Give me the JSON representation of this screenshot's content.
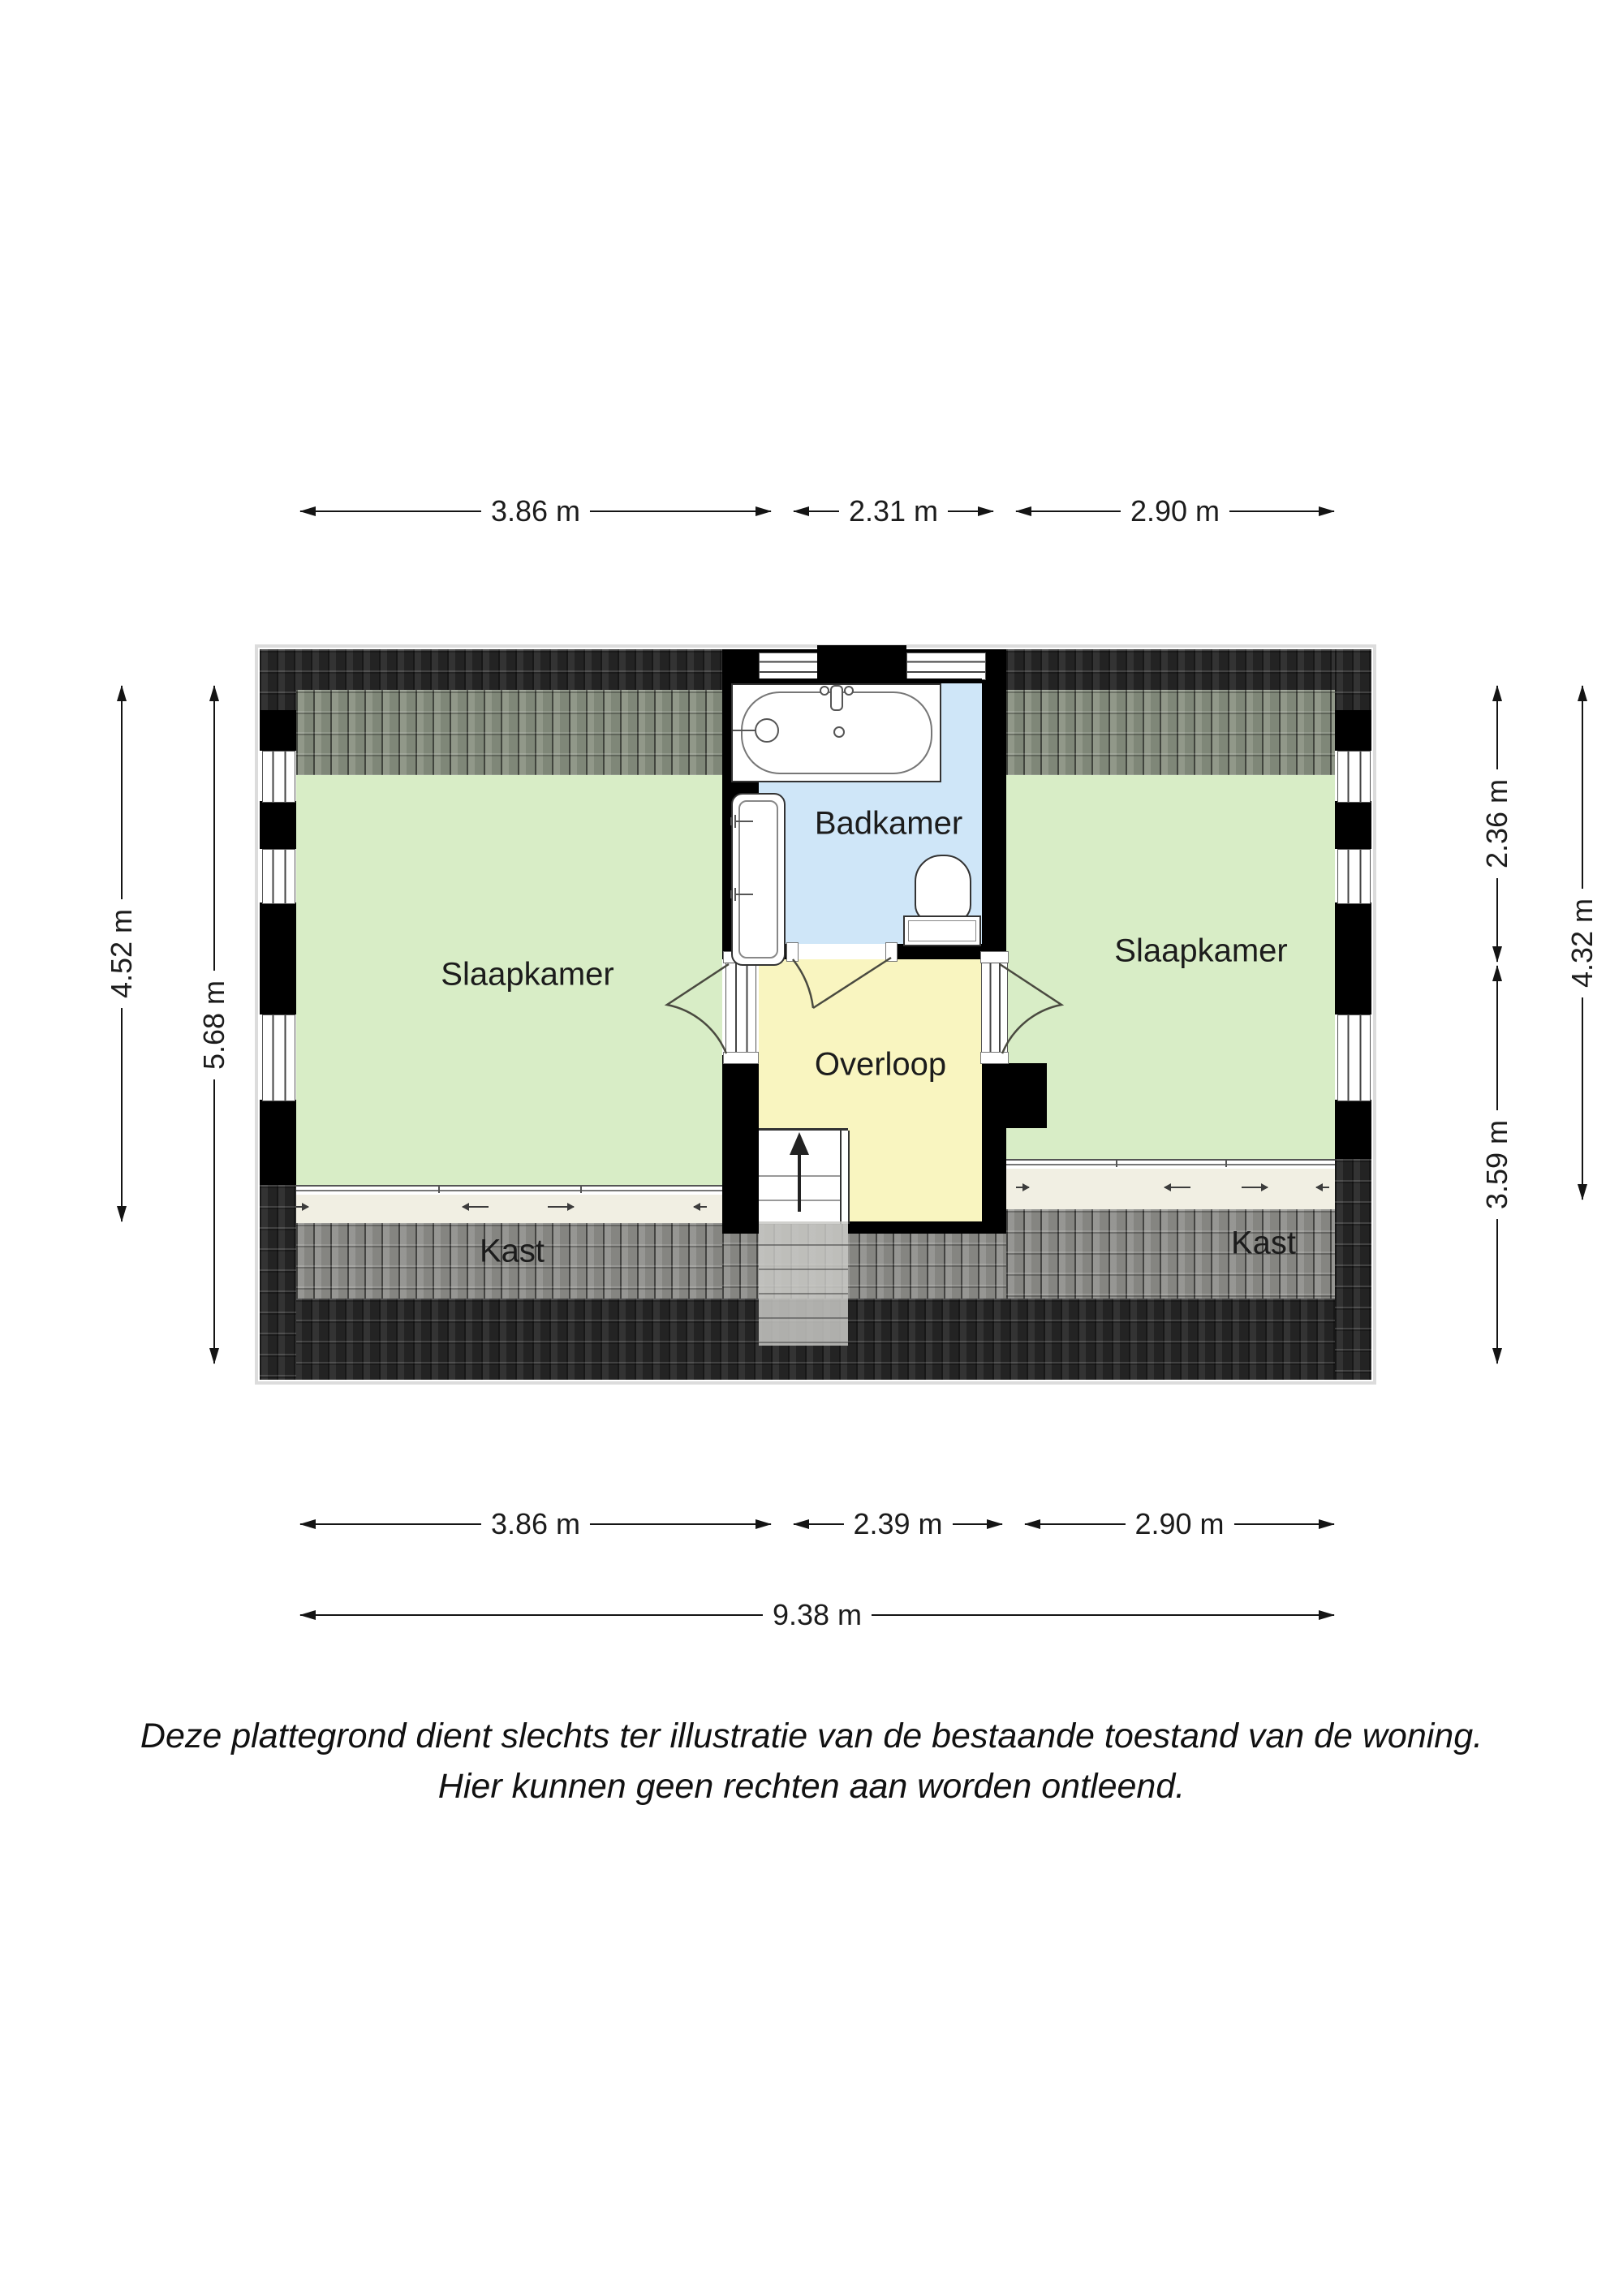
{
  "rooms": {
    "bedroom_left": "Slaapkamer",
    "bedroom_right": "Slaapkamer",
    "bathroom": "Badkamer",
    "landing": "Overloop",
    "closet_left": "Kast",
    "closet_right": "Kast"
  },
  "dimensions": {
    "top": [
      "3.86 m",
      "2.31 m",
      "2.90 m"
    ],
    "bottom": [
      "3.86 m",
      "2.39 m",
      "2.90 m"
    ],
    "total_width": "9.38 m",
    "left": [
      "4.52 m",
      "5.68 m"
    ],
    "right": [
      "2.36 m",
      "3.59 m",
      "4.32 m"
    ]
  },
  "disclaimer": {
    "line1": "Deze plattegrond dient slechts ter illustratie van de bestaande toestand van de woning.",
    "line2": "Hier kunnen geen rechten aan worden ontleend."
  },
  "colors": {
    "room_green": "#d8edc6",
    "bathroom_blue": "#cfe6f8",
    "landing_yellow": "#f9f5c0",
    "closet_floor": "#f1efe3",
    "roof_dark": "#262626",
    "roof_tint_green": "#8a9282",
    "roof_tint_gray": "#90908c",
    "wall": "#000000"
  }
}
